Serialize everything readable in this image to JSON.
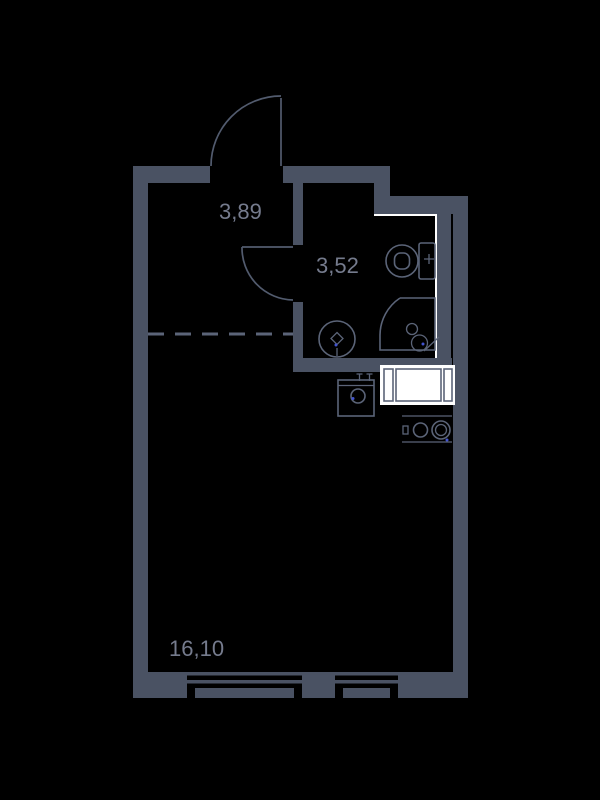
{
  "plan": {
    "rooms": [
      {
        "name": "hallway",
        "area": "3,89"
      },
      {
        "name": "bathroom",
        "area": "3,52"
      },
      {
        "name": "main-room",
        "area": "16,10"
      }
    ],
    "fixtures": [
      "entrance-door-swing-icon",
      "bathroom-door-swing-icon",
      "toilet-icon",
      "washbasin-icon",
      "shower-stall-icon",
      "kitchen-sink-icon",
      "washing-machine-icon",
      "cooktop-two-burner-icon",
      "window-large-icon",
      "window-small-icon",
      "zone-divider-dashed-line"
    ]
  },
  "colors": {
    "bg": "#000000",
    "wall": "#4a5263",
    "label": "#757b8d",
    "fixture": "#5b6478",
    "door": "#525b6e",
    "white": "#ffffff",
    "blue": "#4254d0"
  }
}
